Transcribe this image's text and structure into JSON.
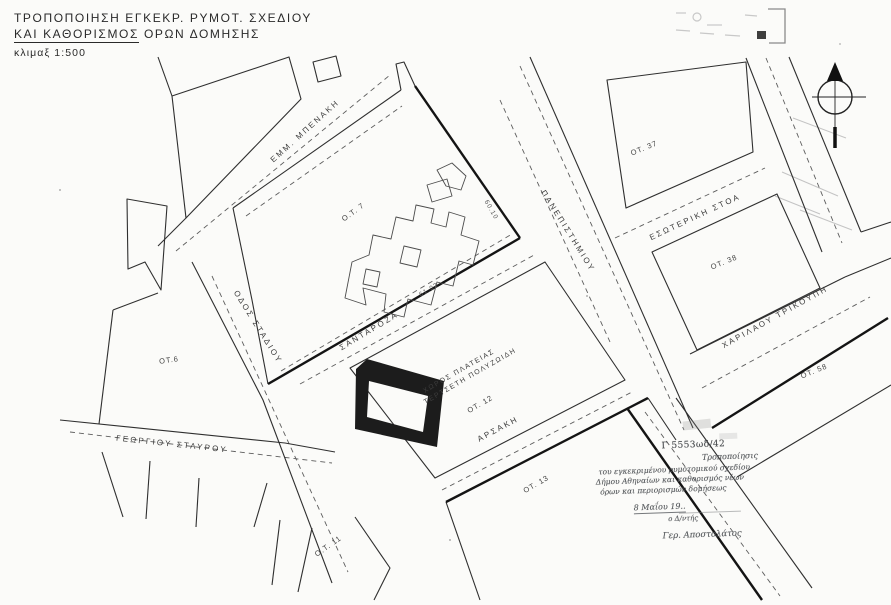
{
  "title": {
    "line1": "ΤΡΟΠΟΠΟΙΗΣΗ ΕΓΚΕΚΡ. ΡΥΜΟΤ. ΣΧΕΔΙΟΥ",
    "line2_underlined": "ΚΑΙ ΚΑΘΟΡΙΣΜΟΣ",
    "line2_rest": "ΟΡΩΝ ΔΟΜΗΣΗΣ",
    "scale": "κλιμαξ 1:500"
  },
  "map": {
    "streets": {
      "emm_benaki": "ΕΜΜ. ΜΠΕΝΑΚΗ",
      "panepistimiou": "ΠΑΝΕΠΙΣΤΗΜΙΟΥ",
      "esoteriki_stoa": "ΕΣΩΤΕΡΙΚΗ ΣΤΟΑ",
      "charilaou_trikoupi": "ΧΑΡΙΛΑΟΥ ΤΡΙΚΟΥΠΗ",
      "odos_stadiou": "ΟΔΟΣ ΣΤΑΔΙΟΥ",
      "santaroza": "ΣΑΝΤΑΡΟΖΑ",
      "georgiou_stavrou": "ΓΕΩΡΓΙΟΥ ΣΤΑΥΡΟΥ",
      "arsaki": "ΑΡΣΑΚΗ"
    },
    "blocks": {
      "ot7": "Ο.Τ. 7",
      "ot37": "ΟΤ. 37",
      "ot38": "ΟΤ. 38",
      "ot58": "ΟΤ. 58",
      "ot6": "ΟΤ.6",
      "ot12": "ΟΤ. 12",
      "ot13": "ΟΤ. 13",
      "ot11": "Ο.Τ. 11"
    },
    "square": {
      "line1": "ΧΩΡΟΣ ΠΛΑΤΕΙΑΣ",
      "line2": "ΤΕΡΤΣΕΤΗ ΠΟΛΥΖΩΙΔΗ"
    },
    "dimensions": {
      "d1": "60.10",
      "d2": "61.02"
    }
  },
  "annotation": {
    "ref": "Γ 5553ωδ/42",
    "line1": "Τροποποίησις",
    "line2": "του εγκεκριμένου ρυμοτομικού σχεδίου",
    "line3": "Δήμου Αθηναίων και καθορισμός νέων",
    "line4": "όρων και περιορισμών δομήσεως",
    "date": "8 Μαΐου 19..",
    "role": "ο Δ/ντής",
    "signature": "Γερ. Αποστολάτος"
  }
}
